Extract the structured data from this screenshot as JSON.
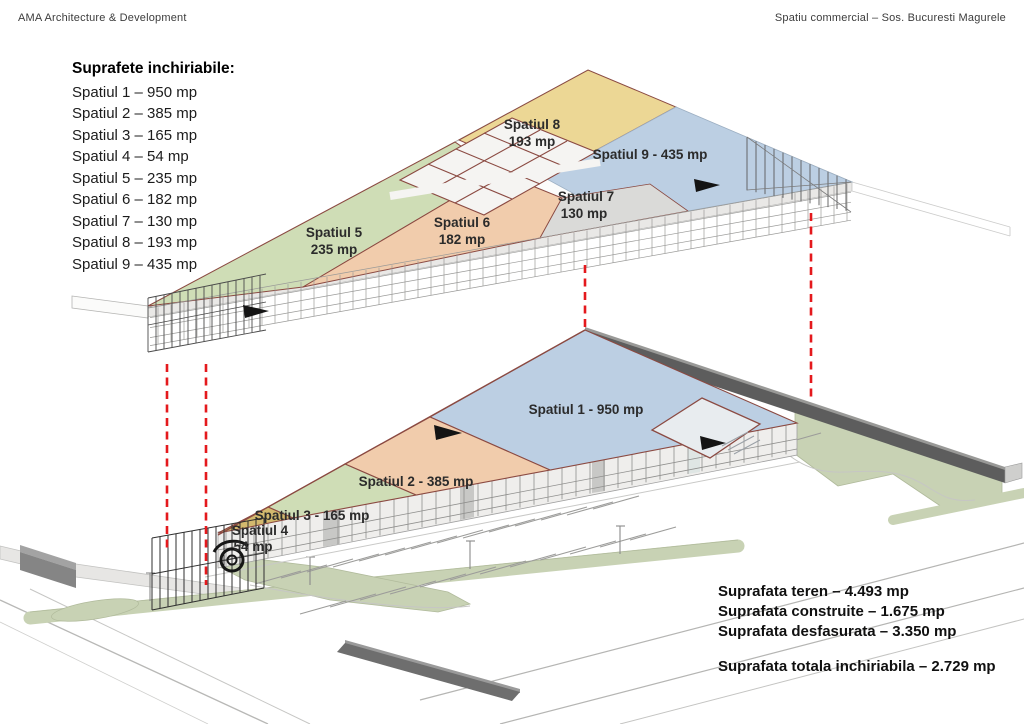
{
  "header": {
    "left": "AMA Architecture & Development",
    "right": "Spatiu commercial – Sos. Bucuresti Magurele"
  },
  "legend": {
    "title": "Suprafete inchiriabile:",
    "items": [
      "Spatiul 1 – 950 mp",
      "Spatiul 2 – 385 mp",
      "Spatiul 3 – 165 mp",
      "Spatiul 4 – 54 mp",
      "Spatiul 5 – 235 mp",
      "Spatiul 6 – 182 mp",
      "Spatiul 7 – 130 mp",
      "Spatiul 8 – 193 mp",
      "Spatiul 9 – 435 mp"
    ]
  },
  "zones": {
    "s1": {
      "label": "Spatiul 1 - 950 mp"
    },
    "s2": {
      "label": "Spatiul 2 - 385 mp"
    },
    "s3": {
      "label": "Spatiul 3 - 165 mp"
    },
    "s4": {
      "name": "Spatiul 4",
      "area": "54 mp"
    },
    "s5": {
      "name": "Spatiul 5",
      "area": "235 mp"
    },
    "s6": {
      "name": "Spatiul 6",
      "area": "182 mp"
    },
    "s7": {
      "name": "Spatiul 7",
      "area": "130 mp"
    },
    "s8": {
      "name": "Spatiul 8",
      "area": "193 mp"
    },
    "s9": {
      "label": "Spatiul 9 - 435 mp"
    }
  },
  "summary": {
    "lines": [
      "Suprafata teren – 4.493 mp",
      "Suprafata construite – 1.675 mp",
      "Suprafata desfasurata – 3.350 mp"
    ],
    "total": "Suprafata totala inchiriabila – 2.729 mp"
  },
  "colors": {
    "zone_green": "#cfddb6",
    "zone_peach": "#f1ccac",
    "zone_yellow": "#ecd795",
    "zone_blue": "#bccfe3",
    "zone_gray": "#dadad8",
    "zone_gold": "#d3b96e",
    "site_green": "#c8d2b4",
    "wall_dark": "#5d5d5d",
    "dashed_red": "#e4191d",
    "outline_red": "#8b4a42"
  }
}
